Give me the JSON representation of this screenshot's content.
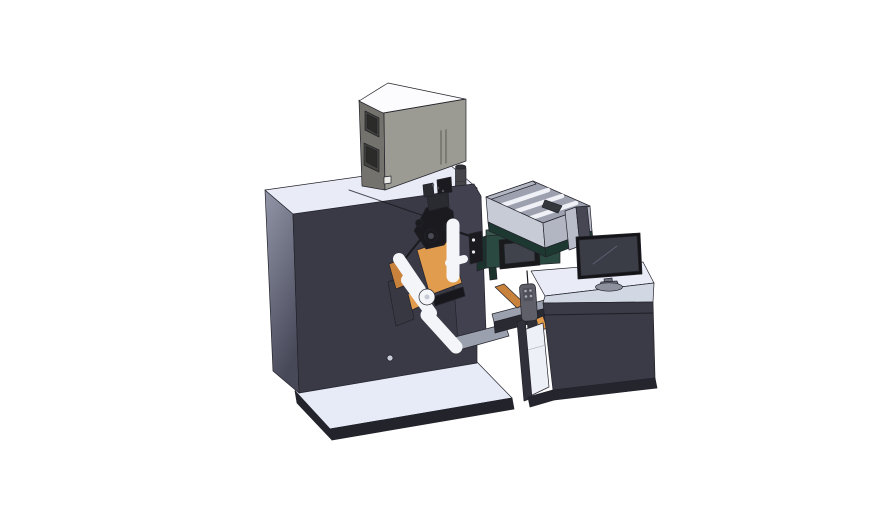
{
  "meta": {
    "description": "3D CAD isometric render of an industrial label printing machine: dark cabinet with electronics box on top, unwind rollers with orange web, teal print unit with small HMI screen, feed tray with rails, and an operator desk with a monitor",
    "background": "#ffffff"
  },
  "colors": {
    "top_light": "#e9ecf7",
    "cabinet_front": "#3a3a46",
    "cabinet_left_top": "#9296a8",
    "cabinet_left_bottom": "#474959",
    "platform_top": "#e7ebf7",
    "platform_edge": "#23232c",
    "box_top": "#fcfcfe",
    "box_front": "#9b9a93",
    "box_side": "#73726c",
    "box_inset": "#44443f",
    "box_inset_inner": "#2b2b29",
    "box_slot": "#6f6e66",
    "box_square": "#ecece9",
    "box_cyl": "#45454a",
    "box_cyl_top": "#2f2f34",
    "plate": "#414150",
    "plate_dark": "#17171c",
    "fin": "#383843",
    "roller": "#f4f5f8",
    "roller_edge": "#b9bdc8",
    "roller_dot": "#c6cad4",
    "orange": "#e29c4d",
    "orange_dark": "#c9823c",
    "black_part": "#1a1a1f",
    "black_part2": "#2a2a31",
    "hub_inner": "#494955",
    "hub_dot": "#55555f",
    "teal_front": "#2a4a41",
    "teal_side": "#1b332c",
    "teal_top": "#39584e",
    "bracket_dot": "#e8eaee",
    "hmi_bezel": "#191a1c",
    "hmi_screen": "#40434b",
    "hmi_button": "#14151a",
    "tray_wall": "#c7cbd6",
    "tray_wall2": "#b2b6c2",
    "tray_inner": "#9da1af",
    "tray_rail": "#eff1f6",
    "tray_base": "#1c3831",
    "tray_blob": "#34373c",
    "magenta": "#c75fc0",
    "beam_top": "#9ba0ae",
    "beam_front": "#2a2a33",
    "support": "#2e2e37",
    "pendant": "#5f5f6a",
    "pendant_inner": "#50505a",
    "pendant_dot": "#a7adb8",
    "shield_light": "#b9bdc9",
    "shield_dark": "#474754",
    "desk_top": "#e9ecf7",
    "desk_edge_band": "#d2d7e4",
    "desk_front": "#3b3b47",
    "desk_interior": "#eef0f7",
    "desk_leg": "#30303a",
    "desk_base": "#25252e",
    "monitor_bezel": "#141417",
    "monitor_screen": "#3a3c46",
    "monitor_line": "#5a6070",
    "monitor_neck": "#6e7280",
    "monitor_base": "#8d919e",
    "white_dot": "#c9cdd6"
  }
}
